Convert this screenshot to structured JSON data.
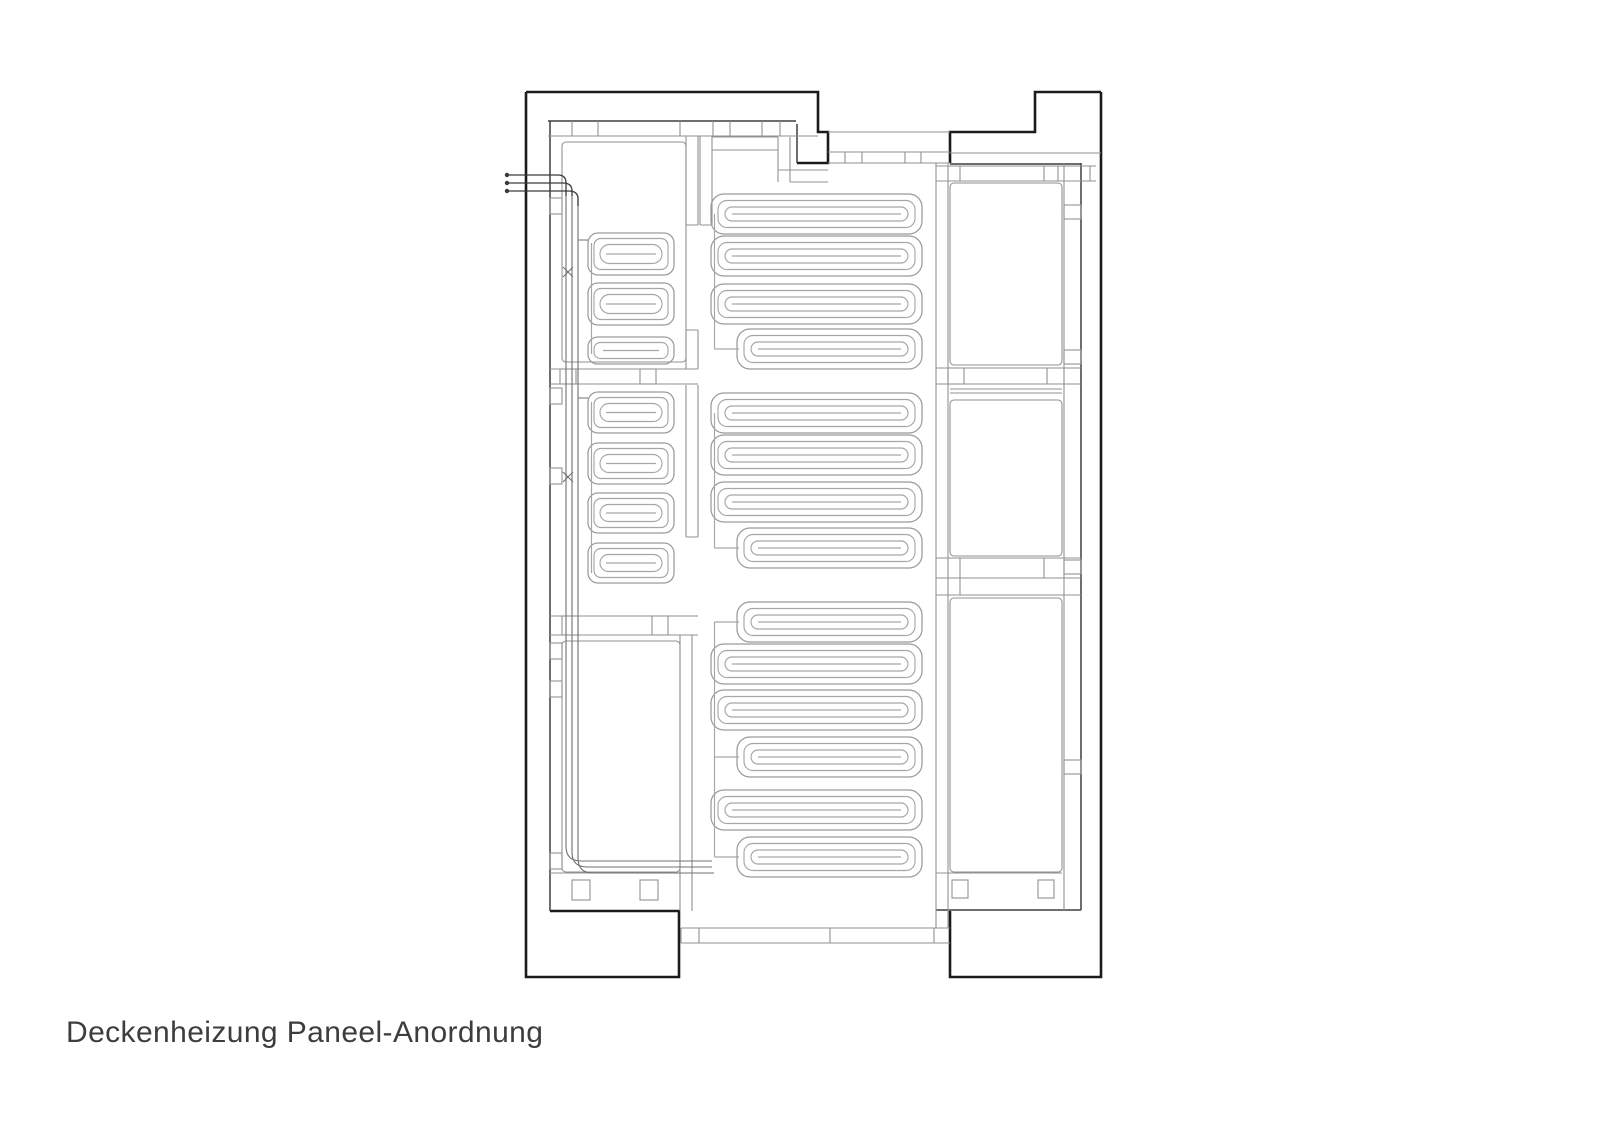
{
  "title": {
    "label": "Deckenheizung Paneel-Anordnung"
  },
  "drawing": {
    "type": "floor-plan",
    "subject": "ceiling heating panel layout",
    "panel_counts": {
      "left_small_panels": 7,
      "center_large_panels": 14,
      "empty_rooms_right": 3
    },
    "colors": {
      "background": "#ffffff",
      "outer_wall": "#1b1b1b",
      "inner_wall": "#3e3e3e",
      "partition": "#929292",
      "coil": "#a6a6a6",
      "coil_outer": "#9a9a9a",
      "pipe": "#707070",
      "pipe_entry": "#3a3a3a",
      "text": "#3d3d3d"
    }
  },
  "panels": {
    "small": {
      "x": 588,
      "w": 86,
      "groups": [
        [
          {
            "top": 233,
            "h": 42
          },
          {
            "top": 283,
            "h": 42
          },
          {
            "top": 337,
            "h": 27
          }
        ],
        [
          {
            "top": 392,
            "h": 41
          },
          {
            "top": 443,
            "h": 41
          },
          {
            "top": 493,
            "h": 40
          },
          {
            "top": 543,
            "h": 40
          }
        ]
      ]
    },
    "large": {
      "x_full": 711,
      "x_short": 737,
      "x_right": 922,
      "h": 40,
      "groups": [
        [
          {
            "top": 194,
            "short": false
          },
          {
            "top": 236,
            "short": false
          },
          {
            "top": 284,
            "short": false
          },
          {
            "top": 329,
            "short": true
          }
        ],
        [
          {
            "top": 393,
            "short": false
          },
          {
            "top": 435,
            "short": false
          },
          {
            "top": 482,
            "short": false
          },
          {
            "top": 528,
            "short": true
          }
        ],
        [
          {
            "top": 602,
            "short": true
          },
          {
            "top": 644,
            "short": false
          },
          {
            "top": 690,
            "short": false
          },
          {
            "top": 737,
            "short": true
          },
          {
            "top": 790,
            "short": false
          },
          {
            "top": 837,
            "short": true
          }
        ]
      ]
    }
  }
}
